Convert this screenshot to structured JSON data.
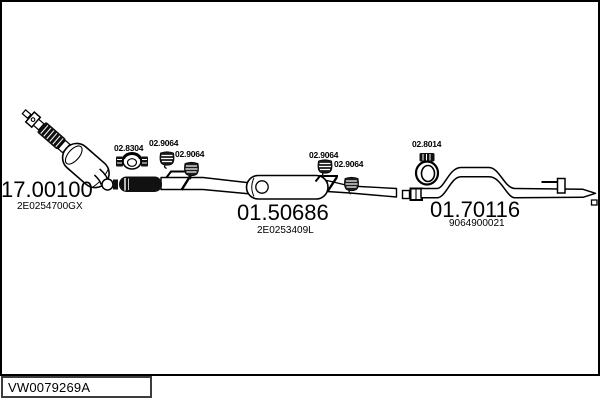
{
  "colors": {
    "ink": "#000000",
    "paper": "#ffffff"
  },
  "doc": {
    "code": "VW0079269A"
  },
  "parts": {
    "catalytic_converter": {
      "number": "17.00100",
      "oem": "2E0254700GX"
    },
    "middle_silencer": {
      "number": "01.50686",
      "oem": "2E0253409L"
    },
    "rear_pipe": {
      "number": "01.70116",
      "oem": "9064900021"
    }
  },
  "fittings": {
    "front_clamp": {
      "number": "02.8304",
      "icon": "pipe-clamp-icon"
    },
    "front_hanger_1": {
      "number": "02.9064",
      "icon": "rubber-hanger-icon"
    },
    "front_hanger_2": {
      "number": "02.9064",
      "icon": "rubber-hanger-icon"
    },
    "mid_hanger_1": {
      "number": "02.9064",
      "icon": "rubber-hanger-icon"
    },
    "mid_hanger_2": {
      "number": "02.9064",
      "icon": "rubber-hanger-icon"
    },
    "rear_clamp": {
      "number": "02.8014",
      "icon": "ring-clamp-icon"
    }
  }
}
